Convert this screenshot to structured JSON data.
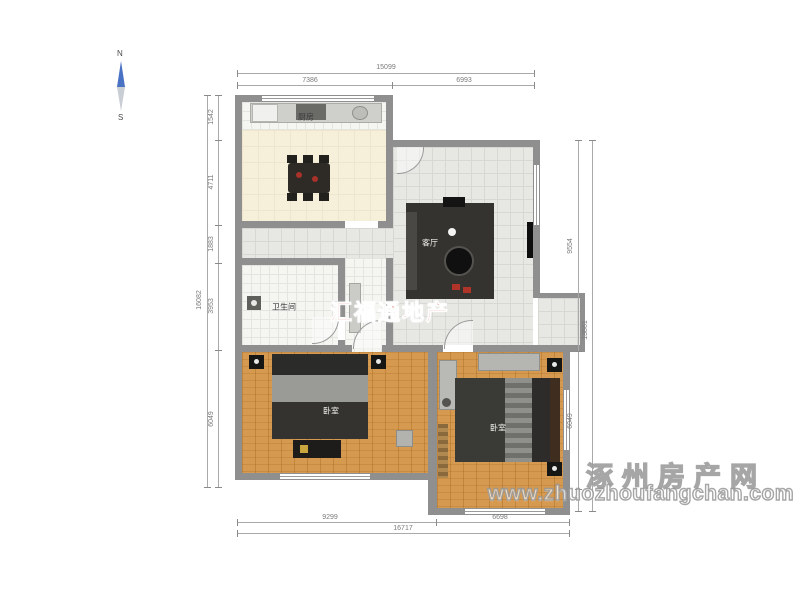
{
  "compass": {
    "north": "N",
    "south": "S"
  },
  "rooms": {
    "kitchen": {
      "label": "厨房"
    },
    "living": {
      "label": "客厅"
    },
    "bathroom": {
      "label": "卫生间"
    },
    "bedroom_left": {
      "label": "卧室"
    },
    "bedroom_right": {
      "label": "卧室"
    }
  },
  "dimensions": {
    "top": {
      "overall": "15099",
      "left": "7386",
      "right": "6993"
    },
    "left_side": {
      "overall": "16082",
      "segments": [
        "1542",
        "4711",
        "1883",
        "3953",
        "6049"
      ]
    },
    "right_side": {
      "overall": "13861",
      "upper": "9554",
      "lower": "6049"
    },
    "bottom": {
      "overall": "16717",
      "left": "9299",
      "right": "6698"
    }
  },
  "watermarks": {
    "agency": "汇福通地产",
    "site_name": "涿州房产网",
    "site_url": "www.zhuozhoufangchan.com"
  },
  "colors": {
    "wall": "#8f8f8f",
    "wood_floor": "#d5994f",
    "cream_floor": "#f6efd9",
    "agency_red": "#d6382c",
    "compass_blue": "#4a72c4"
  }
}
